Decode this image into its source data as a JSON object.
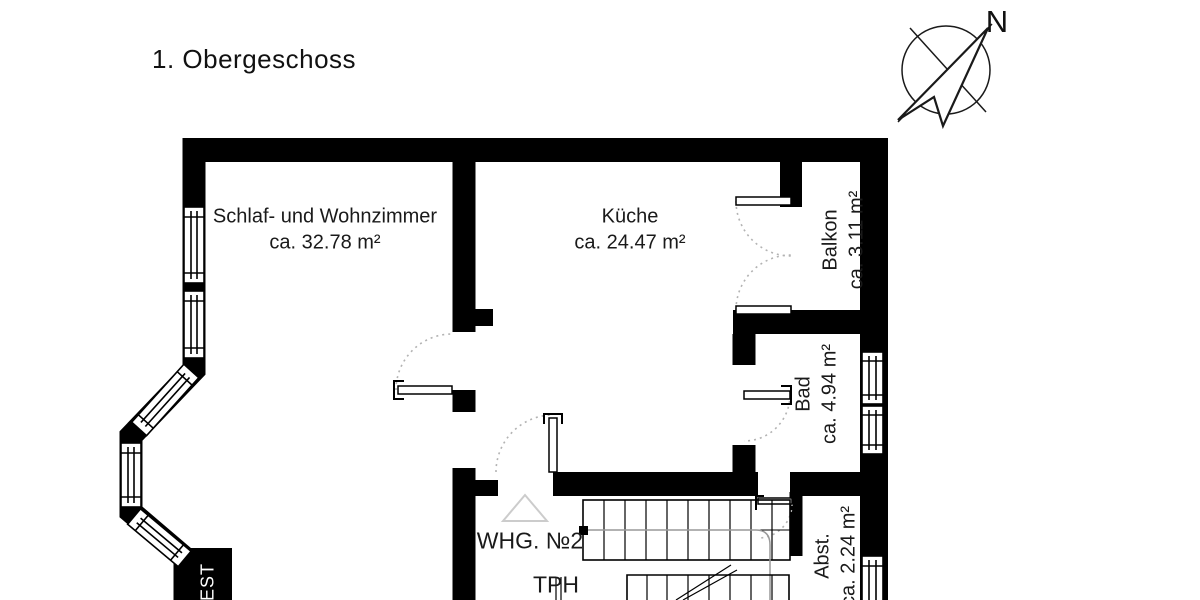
{
  "title": "1. Obergeschoss",
  "compass": {
    "north_label": "N"
  },
  "unit_label": "WHG. №2",
  "wall_text": "NEST",
  "rooms": [
    {
      "name": "Schlaf- und Wohnzimmer",
      "area": "ca. 32.78 m²"
    },
    {
      "name": "Küche",
      "area": "ca. 24.47 m²"
    },
    {
      "name": "Balkon",
      "area": "ca. 3.11 m²"
    },
    {
      "name": "Bad",
      "area": "ca. 4.94 m²"
    },
    {
      "name": "Abst.",
      "area": "ca. 2.24 m²"
    },
    {
      "name": "TPH",
      "area": ""
    }
  ],
  "colors": {
    "wall": "#000000",
    "text": "#1a1a1a",
    "door_arc": "#b3b3b3",
    "stair_guide": "#999999",
    "background": "#ffffff"
  }
}
